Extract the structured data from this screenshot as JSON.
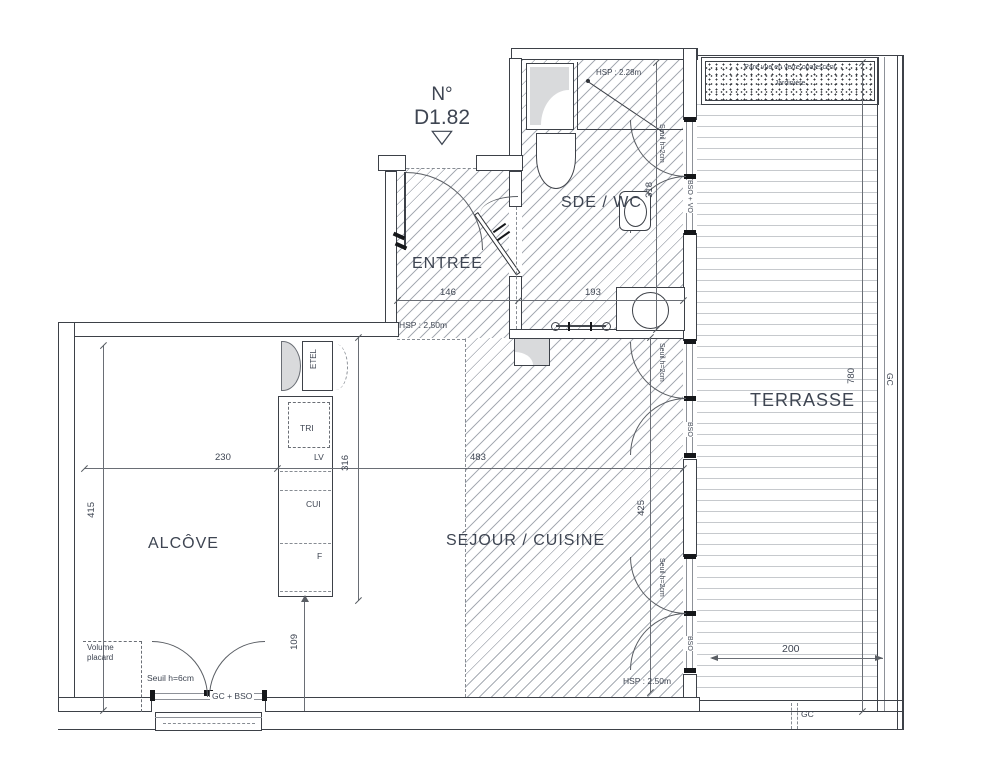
{
  "unit": {
    "prefix": "N°",
    "number": "D1.82"
  },
  "icons": {
    "unit_pointer": "▽"
  },
  "rooms": {
    "entree": "ENTRÉE",
    "sde_wc": "SDE / WC",
    "alcove": "ALCÔVE",
    "sejour_cuisine": "SÉJOUR / CUISINE",
    "terrasse": "TERRASSE"
  },
  "dims": {
    "entree_w": "146",
    "sde_w": "193",
    "sde_d": "318",
    "alcove_w": "230",
    "sejour_w": "483",
    "alcove_d": "415",
    "kitchen_l": "316",
    "bay_w": "109",
    "sejour_d": "425",
    "terrasse_d": "780",
    "terrasse_door_w": "200"
  },
  "annotations": {
    "hsp_sde": "HSP : 2.28m",
    "hsp_entree": "HSP : 2.50m",
    "hsp_sejour": "HSP : 2.50m",
    "seuil_window_top": "Seuil h=2cm",
    "seuil_window_mid": "Seuil h=2cm",
    "seuil_window_bot": "Seuil h=2cm",
    "bso_vo": "BSO + VO",
    "bso_mid": "BSO",
    "bso_bot": "BSO",
    "gc_bso": "GC + BSO",
    "seuil_alcove": "Seuil h=6cm",
    "volume_placard": "Volume\nplacard",
    "gc_right": "GC",
    "gc_bottom": "GC"
  },
  "kitchen": {
    "etel": "ETEL",
    "tri": "TRI",
    "lv": "LV",
    "cui": "CUI",
    "f": "F"
  },
  "terrace": {
    "screen": "Pare vue en verre opalescent",
    "planter": "Jardinière"
  },
  "colors": {
    "line": "#3d4148",
    "text": "#3e4552",
    "hatch": "#a7acb4",
    "deck": "#c6c9cd",
    "fixture_grey": "#d9dadc",
    "frame_black": "#15171a"
  }
}
